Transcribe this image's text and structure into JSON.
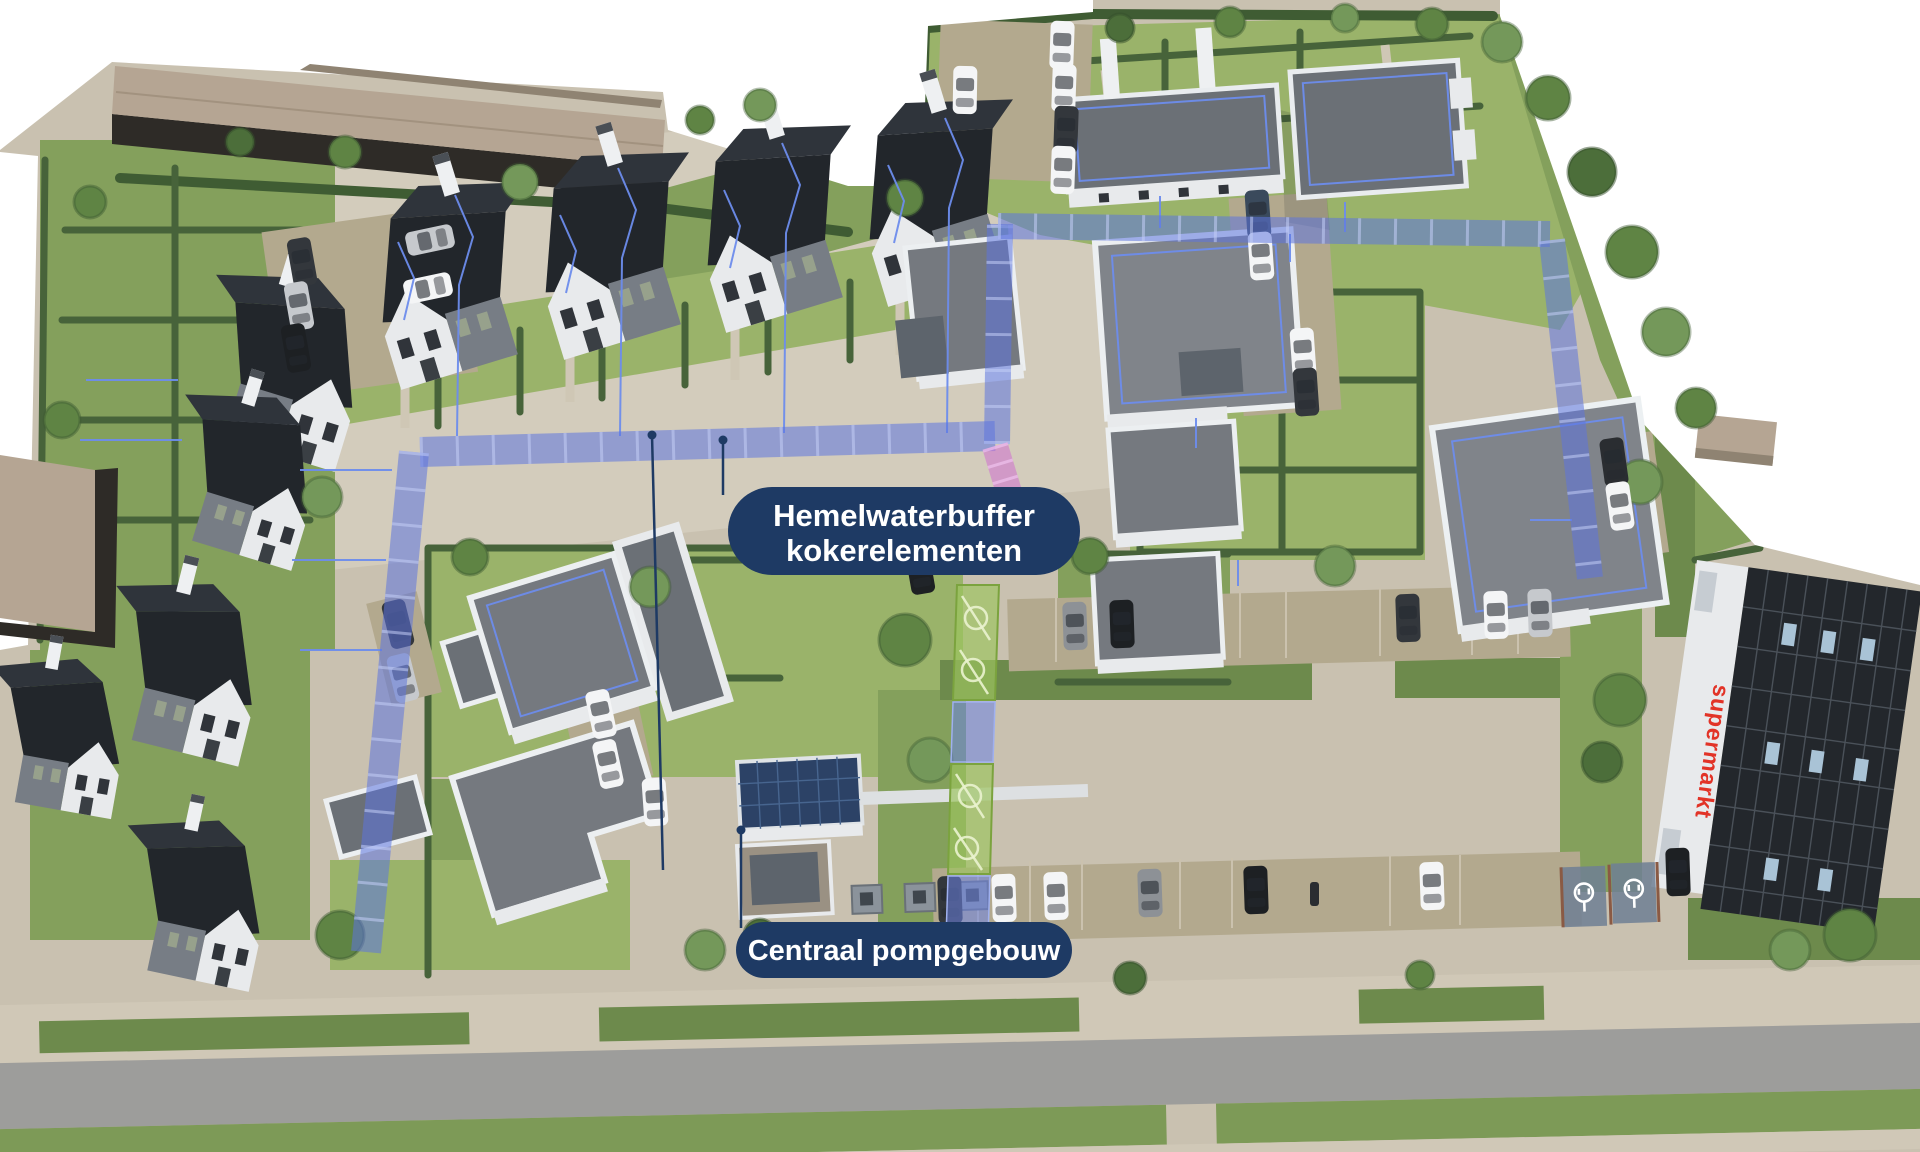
{
  "scene": {
    "type": "aerial-3d-site-render",
    "subject": "residential development with rainwater buffer infrastructure overlay"
  },
  "annotations": {
    "buffer": {
      "line1": "Hemelwaterbuffer",
      "line2": "kokerelementen"
    },
    "pump": {
      "label": "Centraal pompgebouw"
    }
  },
  "signs": {
    "supermarket": "supermarkt"
  },
  "colors": {
    "label_navy": "#1e3a64",
    "label_text": "#ffffff",
    "pipe_blue": "#5d74de",
    "pipe_pink": "#d06fd0",
    "corridor_green": "#9cc45f",
    "supermarket_red": "#e23327"
  },
  "icons": [
    {
      "name": "ev-charging-icon"
    },
    {
      "name": "valve-symbol"
    },
    {
      "name": "leader-dot"
    }
  ]
}
